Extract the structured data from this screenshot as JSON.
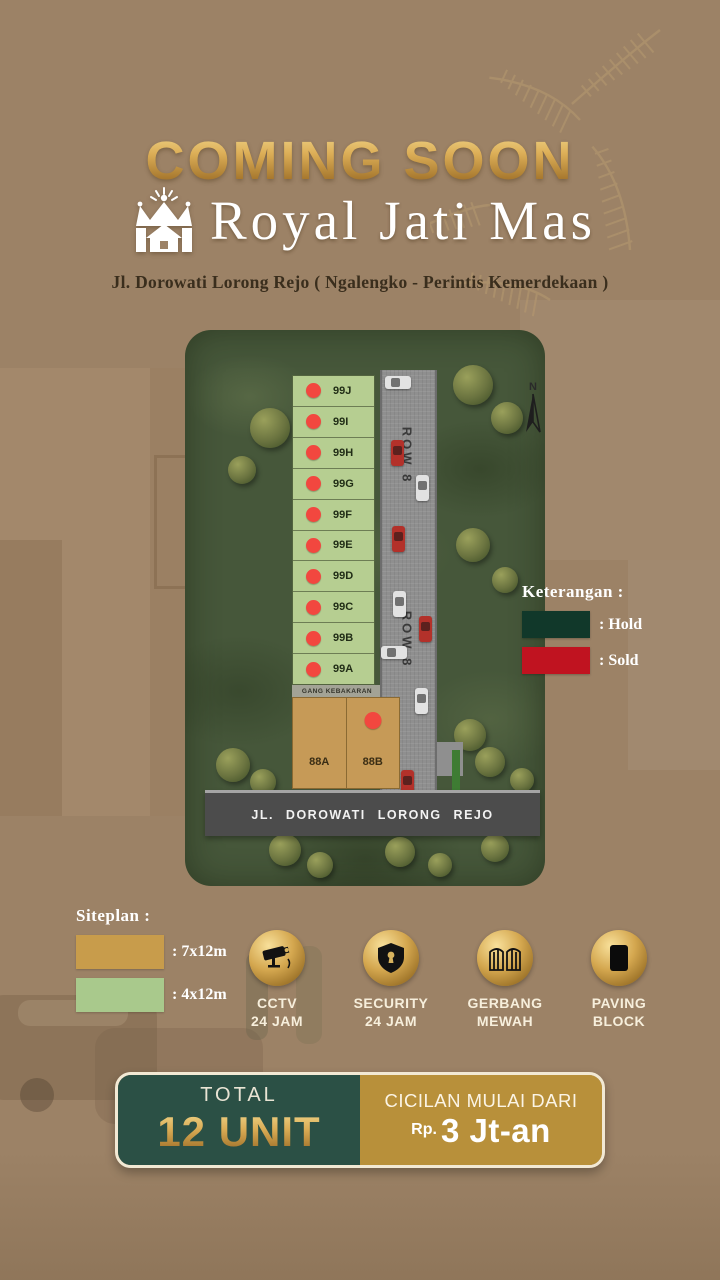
{
  "header": {
    "coming_soon": "COMING SOON",
    "brand": "Royal Jati Mas",
    "address": "Jl. Dorowati Lorong Rejo ( Ngalengko - Perintis Kemerdekaan )"
  },
  "siteplan": {
    "compass_label": "N",
    "row_labels": [
      "ROW 8",
      "ROW 8"
    ],
    "gang_label": "GANG KEBAKARAN",
    "main_road_label": "JL. DOROWATI LORONG REJO",
    "small_lots": [
      {
        "id": "99J",
        "status": "sold"
      },
      {
        "id": "99I",
        "status": "sold"
      },
      {
        "id": "99H",
        "status": "sold"
      },
      {
        "id": "99G",
        "status": "sold"
      },
      {
        "id": "99F",
        "status": "sold"
      },
      {
        "id": "99E",
        "status": "sold"
      },
      {
        "id": "99D",
        "status": "sold"
      },
      {
        "id": "99C",
        "status": "sold"
      },
      {
        "id": "99B",
        "status": "sold"
      },
      {
        "id": "99A",
        "status": "sold"
      }
    ],
    "large_lots": [
      {
        "id": "88A",
        "status": "available"
      },
      {
        "id": "88B",
        "status": "sold"
      }
    ]
  },
  "status_legend": {
    "title": "Keterangan :",
    "items": [
      {
        "label": ": Hold",
        "color": "#11382A"
      },
      {
        "label": ": Sold",
        "color": "#C01320"
      }
    ]
  },
  "size_legend": {
    "title": "Siteplan :",
    "items": [
      {
        "label": ": 7x12m",
        "color": "#C89C4B"
      },
      {
        "label": ": 4x12m",
        "color": "#A9C98C"
      }
    ]
  },
  "amenities": [
    {
      "icon": "cctv-camera",
      "line1": "CCTV",
      "line2": "24 JAM"
    },
    {
      "icon": "security-shield",
      "line1": "SECURITY",
      "line2": "24 JAM"
    },
    {
      "icon": "luxury-gate",
      "line1": "GERBANG",
      "line2": "MEWAH"
    },
    {
      "icon": "paving-block",
      "line1": "PAVING",
      "line2": "BLOCK"
    }
  ],
  "banner": {
    "total_label": "TOTAL",
    "total_value": "12 UNIT",
    "installment_label": "CICILAN MULAI DARI",
    "installment_currency": "Rp.",
    "installment_value": "3 Jt-an"
  },
  "colors": {
    "background": "#9C8266",
    "gold": "#C89C4B",
    "teal_panel": "#2B5045",
    "gold_panel": "#B8903A",
    "hold_green": "#11382A",
    "sold_red": "#C01320",
    "lot_green": "#B6CE91",
    "lot_tan": "#C69A57",
    "sold_dot": "#F2473F"
  }
}
